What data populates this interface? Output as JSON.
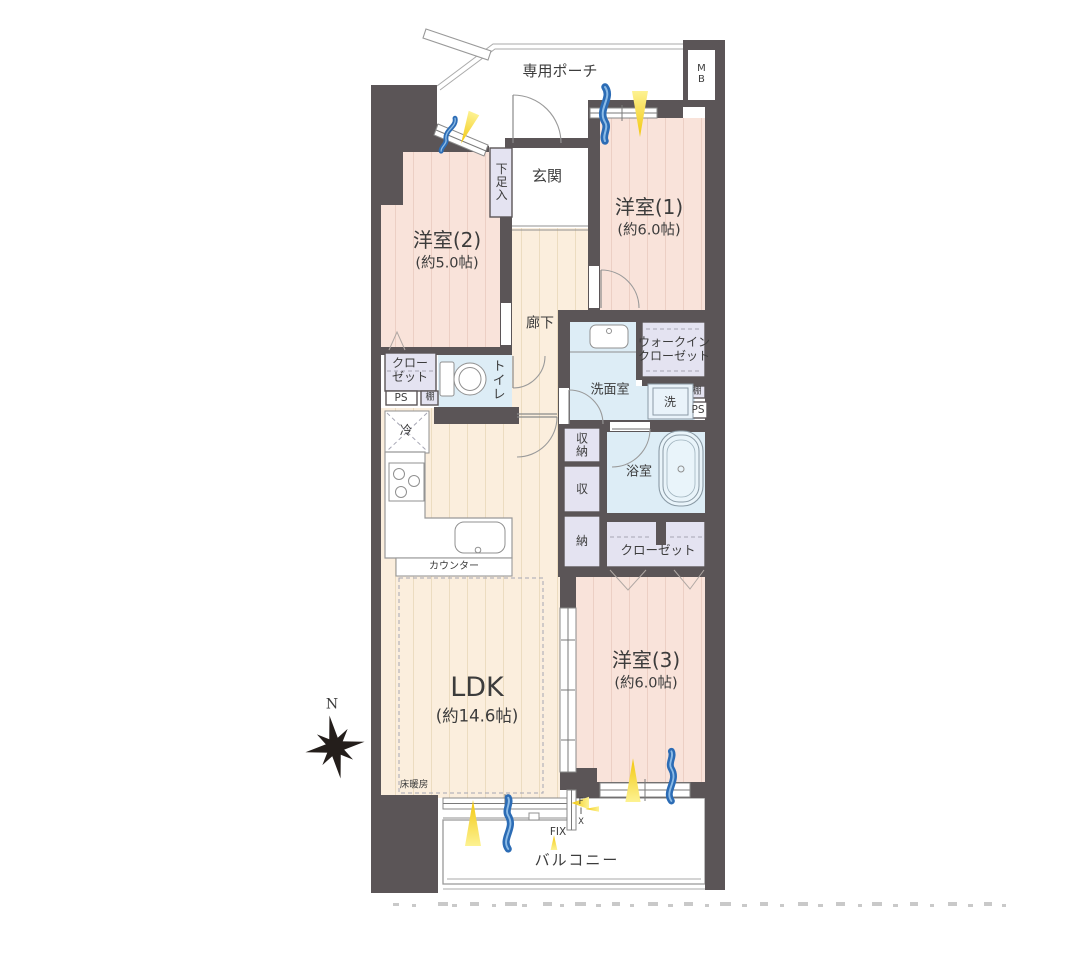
{
  "floorplan": {
    "compass_north": "N",
    "porch_label": "専用ポーチ",
    "meter_box_label": "MB",
    "entrance_label": "玄関",
    "shoe_cabinet_label": "下足入",
    "hallway_label": "廊下",
    "balcony_label": "バルコニー",
    "rooms": {
      "western1": {
        "name": "洋室(1)",
        "area": "(約6.0帖)"
      },
      "western2": {
        "name": "洋室(2)",
        "area": "(約5.0帖)"
      },
      "western3": {
        "name": "洋室(3)",
        "area": "(約6.0帖)"
      },
      "ldk": {
        "name": "LDK",
        "area": "(約14.6帖)"
      }
    },
    "sanitary": {
      "washroom_label": "洗面室",
      "bathroom_label": "浴室",
      "toilet_label": "トイレ",
      "washer_label": "洗"
    },
    "storage": {
      "closet_west2_label": "クロー\nゼット",
      "walkin_closet_label": "ウォークイン\nクローゼット",
      "closet_west3_label": "クローゼット",
      "storage_combined_label": "収\n納",
      "storage_upper_label": "収",
      "storage_lower_label": "納",
      "shelf_left_label": "棚",
      "shelf_right_label": "棚"
    },
    "kitchen": {
      "refrigerator_label": "冷",
      "counter_label": "カウンター",
      "floor_heating_label": "床暖房"
    },
    "utility": {
      "ps_left_label": "PS",
      "ps_right_label": "PS",
      "fix_label": "FIX",
      "fix_vertical_label": "FIX"
    }
  },
  "colors": {
    "wall": "#5b5557",
    "room_pink": "#f9e3da",
    "floor_cream": "#fbeedd",
    "wet_blue": "#ddedf6",
    "closet_lavender": "#e4e3f1",
    "accent_yellow": "#f2c70d",
    "accent_blue": "#2c6cb5"
  }
}
